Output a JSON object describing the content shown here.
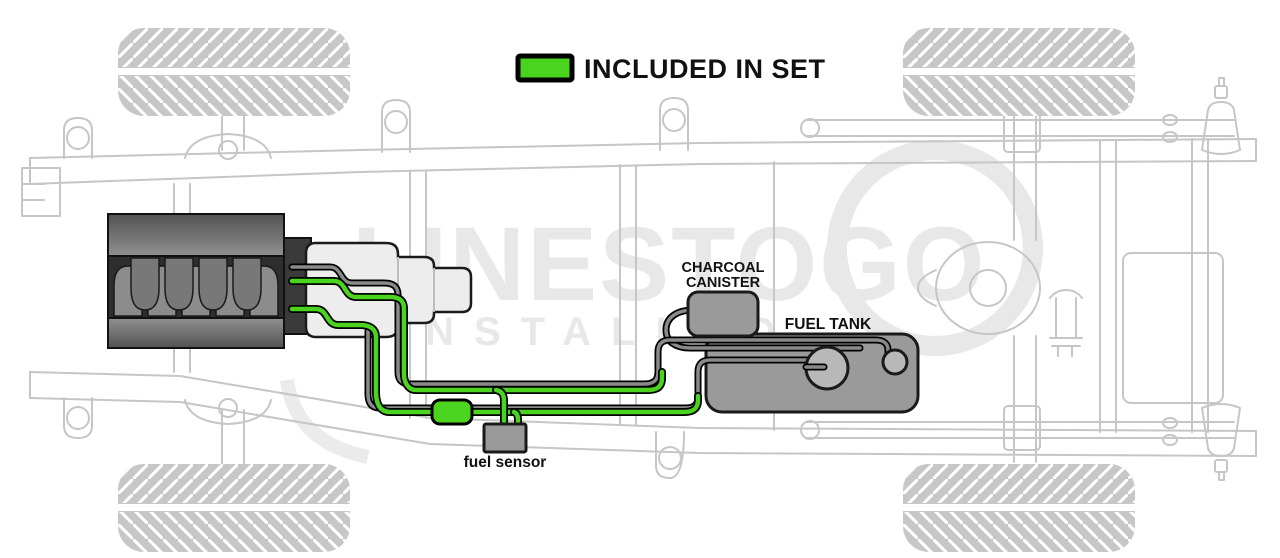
{
  "legend": {
    "label": "INCLUDED IN SET"
  },
  "labels": {
    "charcoal_line1": "CHARCOAL",
    "charcoal_line2": "CANISTER",
    "fuel_tank": "FUEL TANK",
    "fuel_sensor": "fuel sensor"
  },
  "watermark": {
    "line1": "LINESTOGO",
    "line2": "INSTALLED"
  },
  "colors": {
    "included_green": "#4bd41f",
    "component_gray": "#9a9a9a",
    "port_gray": "#b8b8b8",
    "line_gray": "#8a8a8a",
    "chassis_outline": "#c6c6c6",
    "watermark_gray": "#e8e8e8",
    "engine_dark": "#2e2e2e"
  }
}
